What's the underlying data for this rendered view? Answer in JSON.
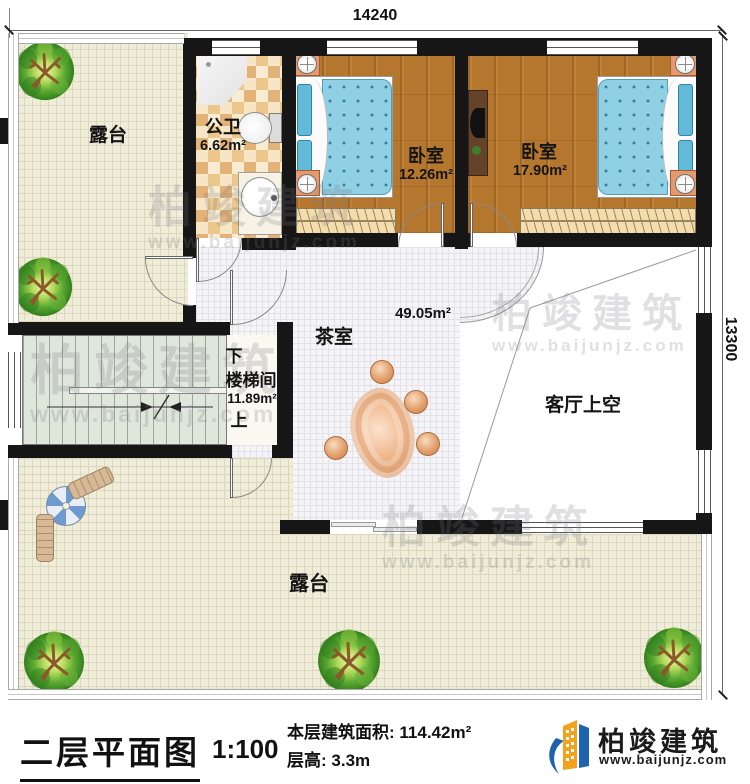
{
  "dimensions": {
    "top": "14240",
    "right": "13300"
  },
  "rooms": {
    "terrace_top": {
      "name": "露台"
    },
    "bathroom": {
      "name": "公卫",
      "area": "6.62m²"
    },
    "bedroom_left": {
      "name": "卧室",
      "area": "12.26m²"
    },
    "bedroom_right": {
      "name": "卧室",
      "area": "17.90m²"
    },
    "tea_room": {
      "name": "茶室",
      "area": "49.05m²"
    },
    "stairwell": {
      "name": "楼梯间",
      "area": "11.89m²",
      "down": "下",
      "up": "上"
    },
    "living_void": {
      "name": "客厅上空"
    },
    "terrace_bottom": {
      "name": "露台"
    }
  },
  "title_block": {
    "title": "二层平面图",
    "scale": "1:100",
    "area_label": "本层建筑面积:",
    "area_value": "114.42m²",
    "floor_height_label": "层高:",
    "floor_height_value": "3.3m"
  },
  "brand": {
    "name": "柏竣建筑",
    "url": "www.baijunjz.com"
  },
  "watermark": {
    "name": "柏竣建筑",
    "url": "www.baijunjz.com"
  },
  "colors": {
    "logo_blue": "#1e63ad",
    "logo_orange": "#f2a21b",
    "wall": "#161616"
  }
}
